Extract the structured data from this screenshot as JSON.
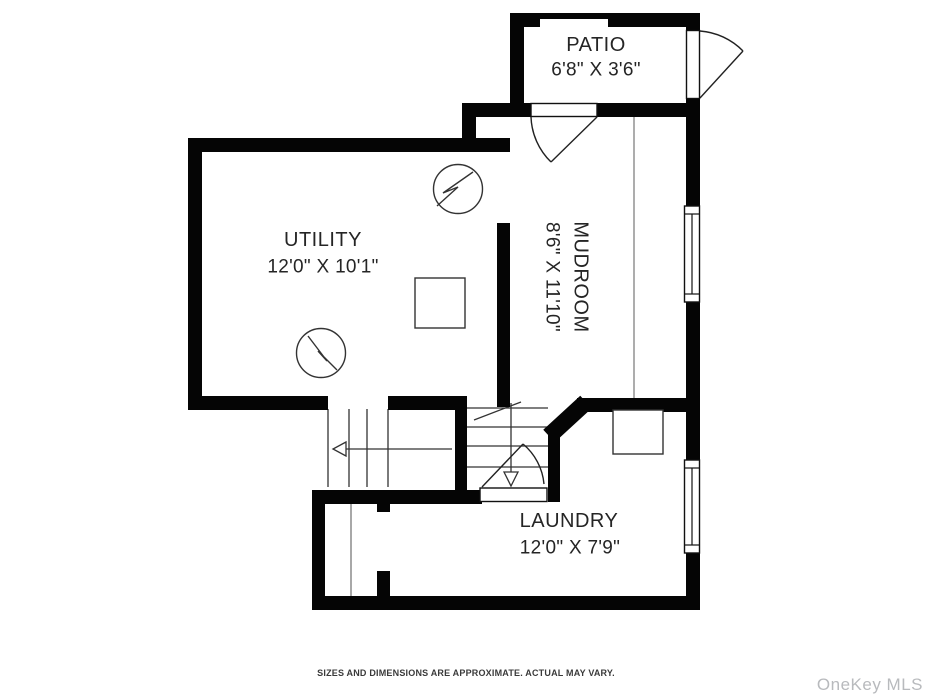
{
  "plan": {
    "title_footer": "SIZES AND DIMENSIONS ARE APPROXIMATE. ACTUAL MAY VARY.",
    "watermark": "OneKey MLS",
    "rooms": [
      {
        "id": "patio",
        "name": "PATIO",
        "dimensions": "6'8\" X 3'6\""
      },
      {
        "id": "utility",
        "name": "UTILITY",
        "dimensions": "12'0\" X 10'1\""
      },
      {
        "id": "mudroom",
        "name": "MUDROOM",
        "dimensions": "8'6\" X 11'10\""
      },
      {
        "id": "laundry",
        "name": "LAUNDRY",
        "dimensions": "12'0\" X 7'9\""
      }
    ],
    "symbols": [
      "utility-meter-circle-top",
      "utility-meter-circle-bottom",
      "utility-equipment-square",
      "laundry-tub-square",
      "patio-exterior-door",
      "mudroom-entry-door",
      "basement-stair-door",
      "mudroom-window",
      "laundry-window",
      "stairs-up-left",
      "stairs-down-right"
    ],
    "colors": {
      "wall": "#050505",
      "line": "#333333",
      "divider": "#8a8a8a",
      "text": "#252525",
      "watermark": "#b8babd",
      "background": "#ffffff"
    }
  }
}
